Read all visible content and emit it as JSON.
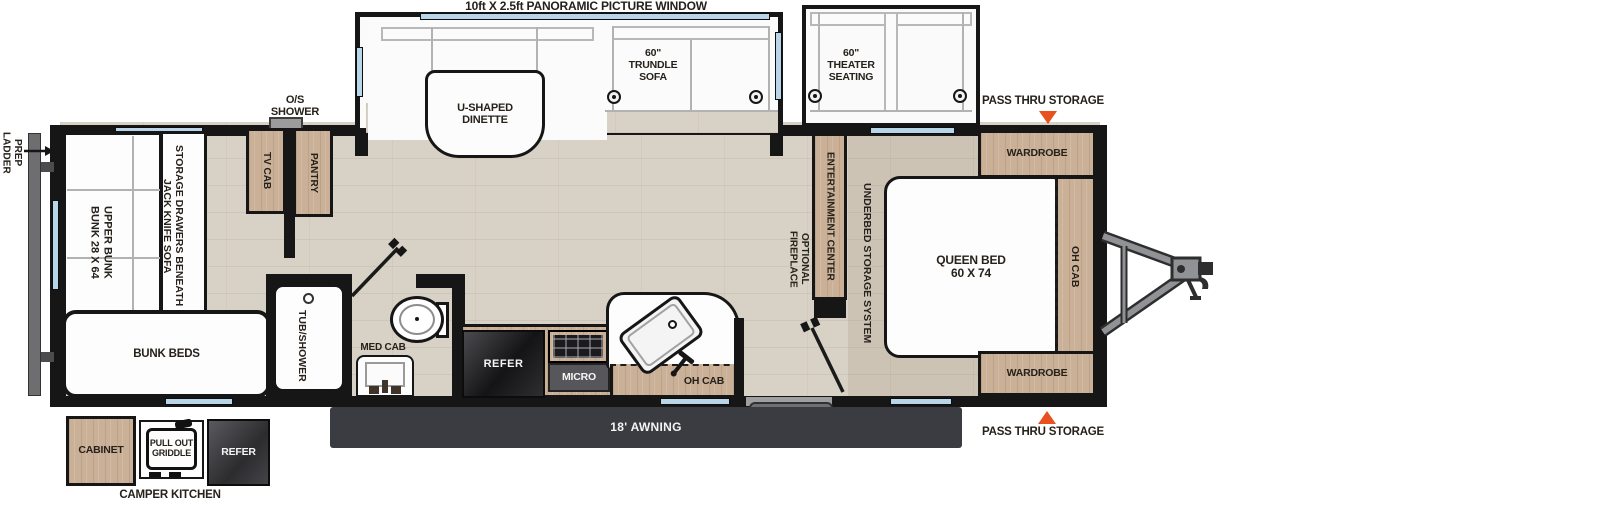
{
  "labels": {
    "panoramic_window": "10ft X 2.5ft PANORAMIC PICTURE WINDOW",
    "u_shaped_dinette": "U-SHAPED\nDINETTE",
    "trundle_sofa": "60\"\nTRUNDLE\nSOFA",
    "theater_seating": "60\"\nTHEATER\nSEATING",
    "pass_thru_storage_top": "PASS THRU STORAGE",
    "pass_thru_storage_bottom": "PASS THRU STORAGE",
    "os_shower": "O/S\nSHOWER",
    "ladder_prep": "LADDER\nPREP",
    "upper_bunk": "BUNK 28 X 64\nUPPER BUNK",
    "jack_knife_sofa": "JACK KNIFE SOFA\nSTORAGE DRAWERS BENEATH",
    "bunk_beds": "BUNK BEDS",
    "tv_cab": "TV CAB",
    "pantry": "PANTRY",
    "tub_shower": "TUB/SHOWER",
    "med_cab": "MED CAB",
    "refer": "REFER",
    "micro": "MICRO",
    "oh_cab_kitchen": "OH CAB",
    "entertainment_center": "ENTERTAINMENT CENTER",
    "optional_fireplace": "OPTIONAL\nFIREPLACE",
    "underbed_storage": "UNDERBED STORAGE SYSTEM",
    "queen_bed": "QUEEN BED\n60 X 74",
    "oh_cab_bedroom": "OH CAB",
    "wardrobe_top": "WARDROBE",
    "wardrobe_bottom": "WARDROBE",
    "entry": "ENTRY",
    "awning": "18' AWNING",
    "camper_cabinet": "CABINET",
    "pull_out_griddle": "PULL OUT\nGRIDDLE",
    "camper_refer": "REFER",
    "camper_kitchen": "CAMPER KITCHEN"
  },
  "colors": {
    "wall": "#161616",
    "floor_wood": "#d8d1c5",
    "cabinet_wood": "#c9b096",
    "window_glass": "#b9d5e8",
    "storage_marker": "#e8501e",
    "awning_bar": "#3b3c41",
    "entry_tag": "#6d6f72",
    "appliance_dark": "#232326"
  }
}
